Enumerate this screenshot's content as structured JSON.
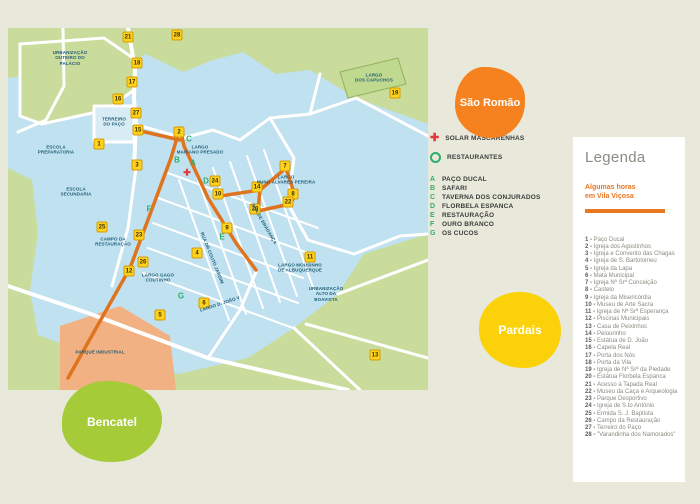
{
  "colors": {
    "pageBg": "#E8E9DB",
    "mapGreen": "#C9DC9B",
    "mapBlue": "#BFE1F0",
    "street": "#FFFFFF",
    "route": "#E0731D",
    "markerBg": "#FFD21E",
    "markerBorder": "#D79A00",
    "letterGreen": "#2FAE6B",
    "red": "#E23A3C",
    "saoRomao": "#F5821F",
    "pardais": "#FBD20A",
    "bencatel": "#A5CB39",
    "parque": "#F2B183",
    "legendaOrange": "#E87722",
    "legendaTitle": "#8B8B80"
  },
  "map": {
    "solar": {
      "x": 179,
      "y": 145
    },
    "markers": [
      {
        "n": "21",
        "x": 120,
        "y": 9
      },
      {
        "n": "28",
        "x": 169,
        "y": 7
      },
      {
        "n": "18",
        "x": 129,
        "y": 35
      },
      {
        "n": "17",
        "x": 124,
        "y": 54
      },
      {
        "n": "16",
        "x": 110,
        "y": 71
      },
      {
        "n": "27",
        "x": 128,
        "y": 85
      },
      {
        "n": "1",
        "x": 91,
        "y": 116
      },
      {
        "n": "15",
        "x": 130,
        "y": 102
      },
      {
        "n": "2",
        "x": 171,
        "y": 104
      },
      {
        "n": "3",
        "x": 129,
        "y": 137
      },
      {
        "n": "24",
        "x": 207,
        "y": 153
      },
      {
        "n": "10",
        "x": 210,
        "y": 166
      },
      {
        "n": "14",
        "x": 249,
        "y": 159
      },
      {
        "n": "20",
        "x": 247,
        "y": 181
      },
      {
        "n": "7",
        "x": 277,
        "y": 138
      },
      {
        "n": "8",
        "x": 285,
        "y": 166
      },
      {
        "n": "22",
        "x": 280,
        "y": 174
      },
      {
        "n": "9",
        "x": 219,
        "y": 200
      },
      {
        "n": "4",
        "x": 189,
        "y": 225
      },
      {
        "n": "23",
        "x": 131,
        "y": 207
      },
      {
        "n": "25",
        "x": 94,
        "y": 199
      },
      {
        "n": "26",
        "x": 135,
        "y": 234
      },
      {
        "n": "12",
        "x": 121,
        "y": 243
      },
      {
        "n": "5",
        "x": 152,
        "y": 287
      },
      {
        "n": "6",
        "x": 196,
        "y": 275
      },
      {
        "n": "11",
        "x": 302,
        "y": 229
      },
      {
        "n": "19",
        "x": 387,
        "y": 65
      },
      {
        "n": "13",
        "x": 367,
        "y": 327
      }
    ],
    "letters": [
      {
        "l": "C",
        "x": 181,
        "y": 111
      },
      {
        "l": "B",
        "x": 169,
        "y": 132
      },
      {
        "l": "A",
        "x": 185,
        "y": 135
      },
      {
        "l": "D",
        "x": 198,
        "y": 153
      },
      {
        "l": "F",
        "x": 141,
        "y": 181
      },
      {
        "l": "E",
        "x": 214,
        "y": 209
      },
      {
        "l": "G",
        "x": 173,
        "y": 268
      }
    ],
    "labels": [
      {
        "text": "URBANIZAÇÃO\nOUTEIRO DO\nPALÁCIO",
        "x": 62,
        "y": 30,
        "rot": 0
      },
      {
        "text": "TERREIRO\nDO PAÇO",
        "x": 106,
        "y": 94,
        "rot": 0
      },
      {
        "text": "ESCOLA\nPREPARATORIA",
        "x": 48,
        "y": 122,
        "rot": 0
      },
      {
        "text": "ESCOLA\nSECUNDARIA",
        "x": 68,
        "y": 164,
        "rot": 0
      },
      {
        "text": "CAMPO DA\nRESTAURAÇÃO",
        "x": 105,
        "y": 214,
        "rot": 0
      },
      {
        "text": "LARGO\nMARIANO PRESADO",
        "x": 192,
        "y": 122,
        "rot": 0
      },
      {
        "text": "LARGO\nNUNO ÁLVARES PEREIRA",
        "x": 278,
        "y": 152,
        "rot": 0
      },
      {
        "text": "LARGO GAGO\nCOUTINHO",
        "x": 150,
        "y": 250,
        "rot": 0
      },
      {
        "text": "LARGO D. JOÃO V",
        "x": 212,
        "y": 276,
        "rot": -18
      },
      {
        "text": "PARQUE INDUSTRIAL",
        "x": 92,
        "y": 324,
        "rot": 0
      },
      {
        "text": "LARGO\nDOS CAPUCHOS",
        "x": 366,
        "y": 50,
        "rot": 0
      },
      {
        "text": "LARGO MOUSINHO\nDE ALBUQUERQUE",
        "x": 292,
        "y": 240,
        "rot": 0
      },
      {
        "text": "URBANIZAÇÃO\nALTO DA\nBOAVISTA",
        "x": 318,
        "y": 266,
        "rot": 0
      },
      {
        "text": "RUA DE BRAGANÇA",
        "x": 256,
        "y": 196,
        "rot": 60
      },
      {
        "text": "RUA DR COUTO JARDIM",
        "x": 204,
        "y": 230,
        "rot": 68
      }
    ]
  },
  "key": {
    "solar_label": "SOLAR MASCARENHAS",
    "restaurantes_label": "RESTAURANTES",
    "items": [
      {
        "letter": "A",
        "label": "PAÇO DUCAL"
      },
      {
        "letter": "B",
        "label": "SAFARI"
      },
      {
        "letter": "C",
        "label": "TAVERNA DOS CONJURADOS"
      },
      {
        "letter": "D",
        "label": "FLORBELA ESPANCA"
      },
      {
        "letter": "E",
        "label": "RESTAURAÇÃO"
      },
      {
        "letter": "F",
        "label": "OURO BRANCO"
      },
      {
        "letter": "G",
        "label": "OS CUCOS"
      }
    ]
  },
  "regions": {
    "sao_romao": "São Romão",
    "pardais": "Pardais",
    "bencatel": "Bencatel"
  },
  "legend": {
    "title": "Legenda",
    "subtitle_line1": "Algumas horas",
    "subtitle_line2": "em Vila Viçosa",
    "items": [
      {
        "num": "1",
        "label": "Paço Ducal"
      },
      {
        "num": "2",
        "label": "Igreja dos Agostinhos"
      },
      {
        "num": "3",
        "label": "Igreja e Convento das Chagas"
      },
      {
        "num": "4",
        "label": "Igreja de S. Bartolomeu"
      },
      {
        "num": "5",
        "label": "Igreja da Lapa"
      },
      {
        "num": "6",
        "label": "Mata Municipal"
      },
      {
        "num": "7",
        "label": "Igreja Nª Srª Conceição"
      },
      {
        "num": "8",
        "label": "Castelo"
      },
      {
        "num": "9",
        "label": "Igreja da Misericórdia"
      },
      {
        "num": "10",
        "label": "Museu de Arte Sacra"
      },
      {
        "num": "11",
        "label": "Igreja de Nª Srª Esperança"
      },
      {
        "num": "12",
        "label": "Piscinas Municipais"
      },
      {
        "num": "13",
        "label": "Casa de Peixinhos"
      },
      {
        "num": "14",
        "label": "Pelourinho"
      },
      {
        "num": "15",
        "label": "Estátua de D. João"
      },
      {
        "num": "16",
        "label": "Capela Real"
      },
      {
        "num": "17",
        "label": "Porta dos Nós"
      },
      {
        "num": "18",
        "label": "Porta da Vila"
      },
      {
        "num": "19",
        "label": "Igreja de Nª Srª da Piedade"
      },
      {
        "num": "20",
        "label": "Estátua Florbela Espanca"
      },
      {
        "num": "21",
        "label": "Acesso à Tapada Real"
      },
      {
        "num": "22",
        "label": "Museu da Caça e Arqueologia"
      },
      {
        "num": "23",
        "label": "Parque Desportivo"
      },
      {
        "num": "24",
        "label": "Igreja de S.to António"
      },
      {
        "num": "25",
        "label": "Ermida S. J. Baptista"
      },
      {
        "num": "26",
        "label": "Campo da Restauração"
      },
      {
        "num": "27",
        "label": "Terreiro do Paço"
      },
      {
        "num": "28",
        "label": "\"Varandinha dos Namorados\""
      }
    ]
  }
}
